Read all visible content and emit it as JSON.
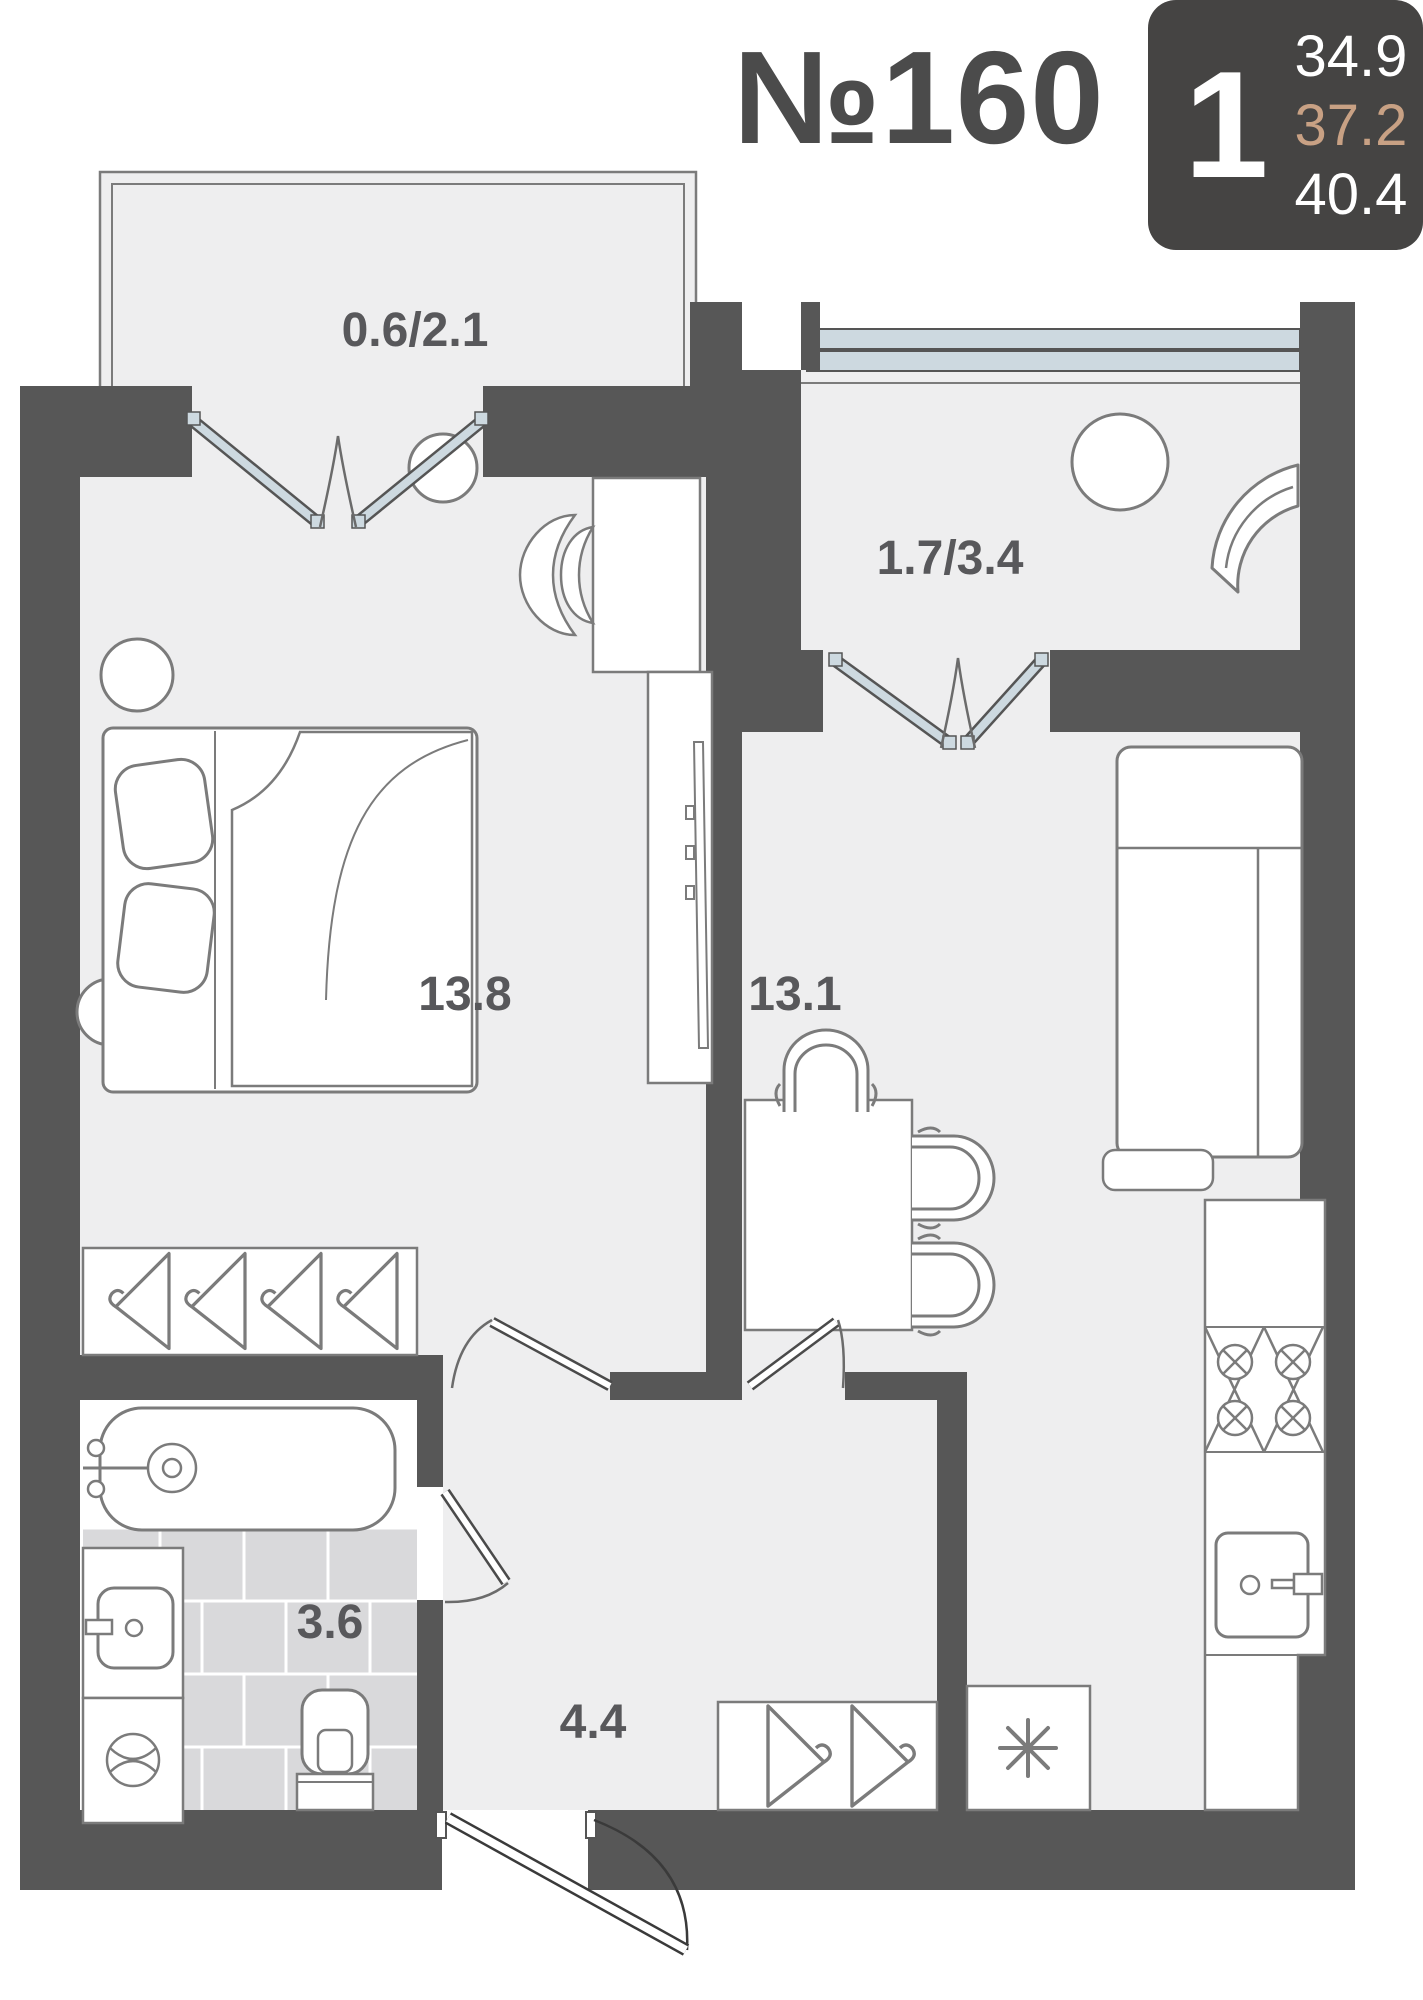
{
  "header": {
    "unit_number": "№160",
    "rooms_count": "1",
    "area_living": "34.9",
    "area_no_balcony": "37.2",
    "area_total": "40.4"
  },
  "areas": {
    "balcony_left": "0.6/2.1",
    "balcony_right": "1.7/3.4",
    "bedroom": "13.8",
    "living_kitchen": "13.1",
    "bathroom": "3.6",
    "hallway": "4.4"
  },
  "icons": {
    "refrigerator_mark": "asterisk"
  },
  "colors": {
    "wall": "#575757",
    "floor": "#eeeeef",
    "tile": "#d9d9db",
    "badge_bg": "#454443",
    "accent_tan": "#c8a184",
    "glass_blue": "#cdd9e0",
    "outline": "#7b7b7b",
    "label_text": "#58585b"
  }
}
